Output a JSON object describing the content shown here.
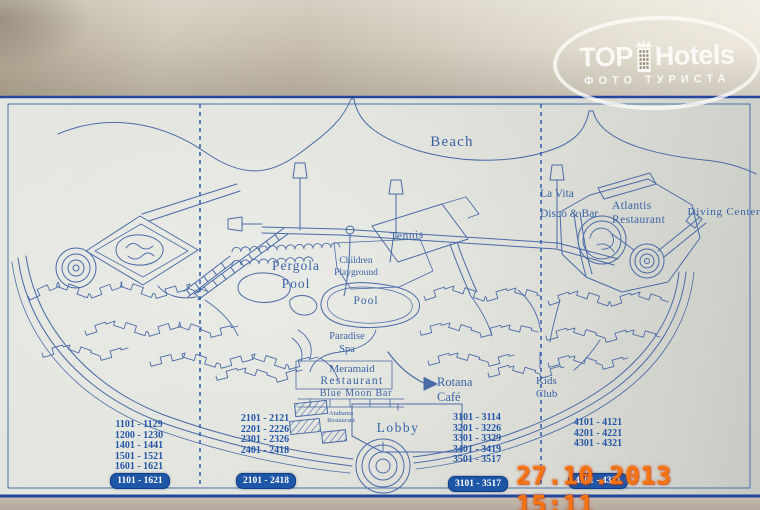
{
  "watermark": {
    "top": "TOP",
    "hotels": "Hotels",
    "subtitle": "ФОТО ТУРИСТА"
  },
  "timestamp": "27.10.2013 15:11",
  "map": {
    "labels": {
      "beach": "Beach",
      "la_vita": [
        "La Vita",
        "Disco & Bar"
      ],
      "atlantis": [
        "Atlantis",
        "Restaurant"
      ],
      "diving_center": "Diving Center",
      "tennis": "Tennis",
      "pergola_pool": [
        "Pergola",
        "Pool"
      ],
      "children_playground": [
        "Children",
        "Playground"
      ],
      "pool": "Pool",
      "paradise_spa": [
        "Paradise",
        "Spa"
      ],
      "meramaid": [
        "Meramaid",
        "Restaurant"
      ],
      "blue_moon": "Blue Moon Bar",
      "rotana": [
        "Rotana",
        "Café"
      ],
      "andiamo": [
        "Andiamo",
        "Restaurant"
      ],
      "lobby": "Lobby",
      "kids_club": [
        "Kids",
        "Club"
      ]
    },
    "room_columns": [
      {
        "ranges": [
          "1101 - 1129",
          "1200 - 1230",
          "1401 - 1441",
          "1501 - 1521",
          "1601 - 1621"
        ],
        "badge": "1101 - 1621"
      },
      {
        "ranges": [
          "2101 - 2121",
          "2201 - 2226",
          "2301 - 2326",
          "2401 - 2418"
        ],
        "badge": "2101 - 2418"
      },
      {
        "ranges": [
          "3101 - 3114",
          "3201 - 3226",
          "3301 - 3329",
          "3401 - 3419",
          "3501 - 3517"
        ],
        "badge": "3101 - 3517"
      },
      {
        "ranges": [
          "4101 - 4121",
          "4201 - 4221",
          "4301 - 4321"
        ],
        "badge": "4101 - 4321"
      }
    ],
    "colors": {
      "ink": "#4a6aa8",
      "badge_bg": "#1e56a8",
      "badge_text": "#ffffff",
      "timestamp": "#f5740f"
    }
  }
}
